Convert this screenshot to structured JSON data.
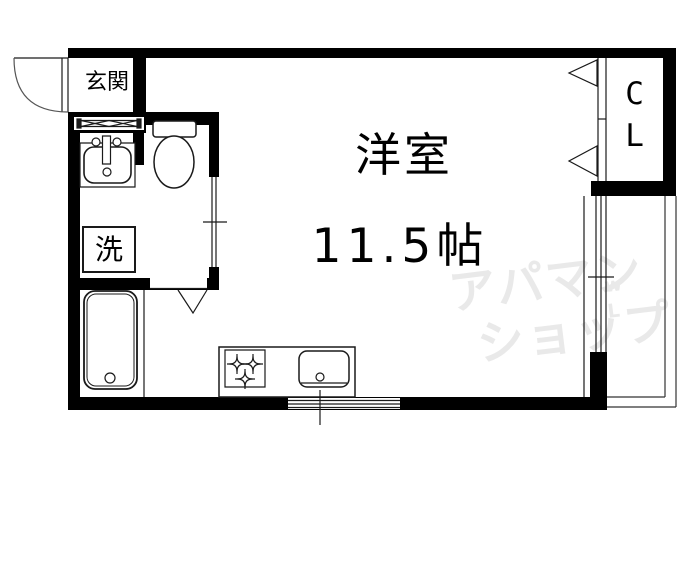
{
  "canvas": {
    "width": 690,
    "height": 575,
    "background": "#ffffff"
  },
  "colors": {
    "wall": "#000000",
    "line": "#1a1a1a",
    "watermark": "#e9e9e9"
  },
  "rooms": {
    "entrance": {
      "label": "玄関"
    },
    "main_room": {
      "label": "洋室",
      "size": "11.5帖"
    },
    "closet": {
      "label": "CL"
    },
    "laundry": {
      "label": "洗"
    }
  },
  "fixtures": {
    "entrance_door": "swing-door",
    "entrance_partition": "accordion-panel",
    "washbasin": "washbasin",
    "toilet": "toilet",
    "bathtub": "bathtub",
    "bathroom_door": "folding-door",
    "washroom_door": "sliding-door",
    "stove": "three-burner-stove",
    "kitchen_sink": "kitchen-sink",
    "closet_door": "folding-door",
    "right_window": "sliding-window",
    "bottom_window": "sliding-window",
    "balcony": "balcony"
  },
  "watermark": {
    "line1": "アパマン",
    "line2": "ショップ",
    "marks": "w\nL"
  }
}
